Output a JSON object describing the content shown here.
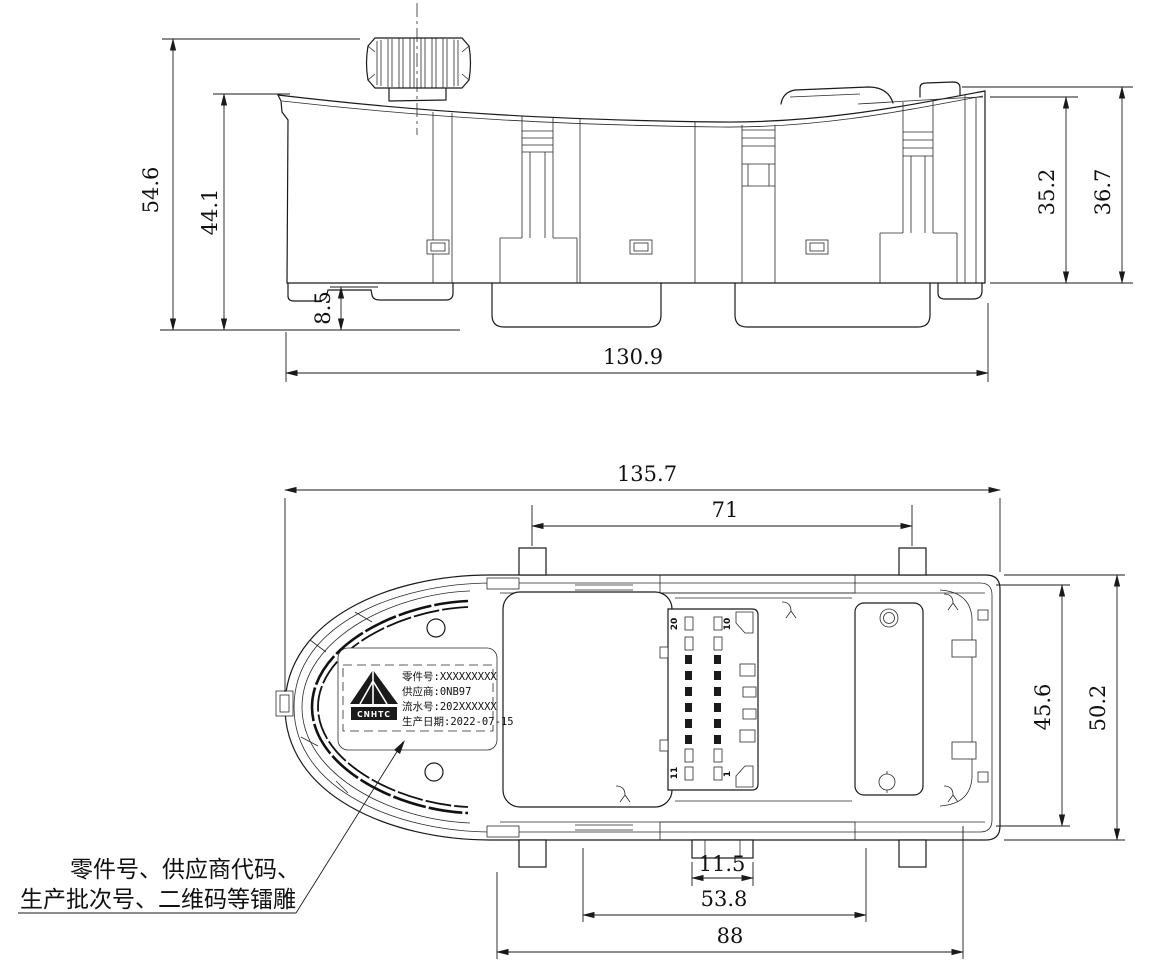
{
  "side_view": {
    "dim_total_height": "54.6",
    "dim_body_height": "44.1",
    "dim_foot_height": "8.5",
    "dim_overall_width": "130.9",
    "dim_front_height": "35.2",
    "dim_rear_height": "36.7"
  },
  "bottom_view": {
    "dim_overall_length": "135.7",
    "dim_tab_spacing": "71",
    "dim_inner_width": "45.6",
    "dim_overall_width": "50.2",
    "dim_center_tab": "11.5",
    "dim_opening": "53.8",
    "dim_mount_span": "88",
    "pins": {
      "top_left": "20",
      "top_right": "10",
      "bottom_left": "11",
      "bottom_right": "1"
    },
    "label": {
      "logo": "CNHTC",
      "line1": "零件号:XXXXXXXXX",
      "line2": "供应商:0NB97",
      "line3": "流水号:202XXXXXX",
      "line4": "生产日期:2022-07-15"
    }
  },
  "callout": {
    "line1": "零件号、供应商代码、",
    "line2": "生产批次号、二维码等镭雕"
  }
}
